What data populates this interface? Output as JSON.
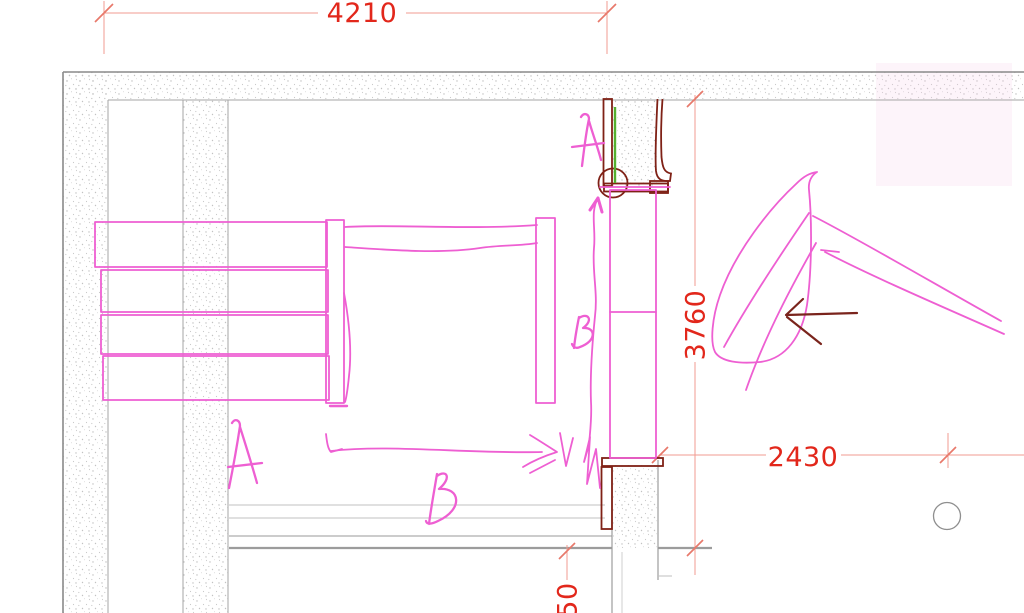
{
  "drawing": {
    "title": "floor-plan-detail",
    "dimensions": {
      "top_width": "4210",
      "left_room_depth": "3760",
      "right_width": "2430",
      "bottom_offset": "50"
    },
    "sketch_annotations": {
      "top_letter_a": "A",
      "top_letter_b": "B",
      "bottom_letter_a": "A",
      "bottom_letter_b": "B"
    },
    "colors": {
      "dimension_text_red": "#e2271b",
      "dimension_line_salmon": "#f29b90",
      "dimension_tick_salmon": "#e8796b",
      "sketch_magenta": "#ee5fd2",
      "door_frame_maroon": "#7f2116",
      "door_accent_green": "#55b030",
      "wall_line_gray": "#9a9a9a",
      "highlight_pink": "#fbe3f0"
    }
  }
}
